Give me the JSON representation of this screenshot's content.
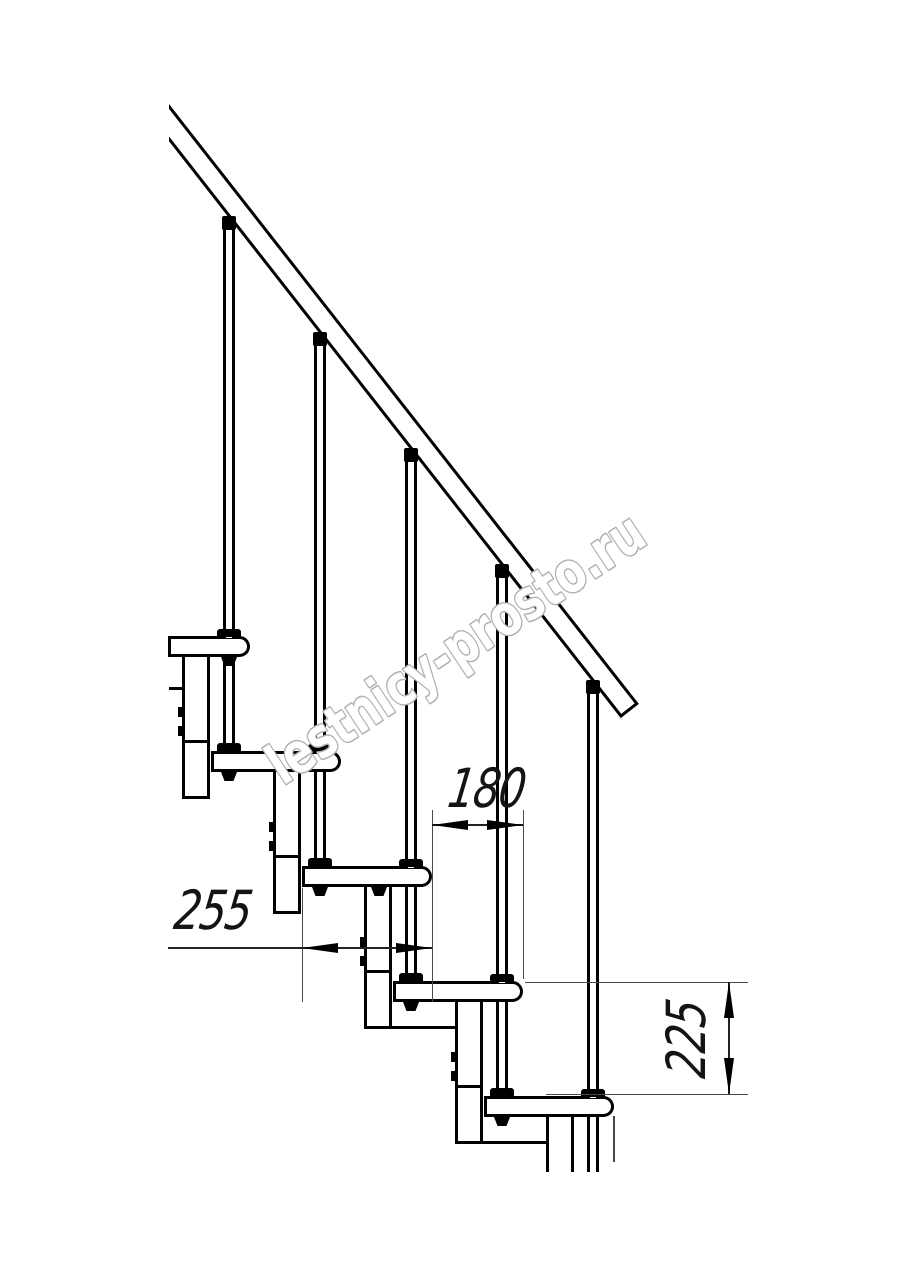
{
  "page": {
    "background": "#ffffff",
    "width": 914,
    "height": 1280
  },
  "watermark": {
    "text": "lestnicy-prosto.ru",
    "stroke_color": "#b0b0b0",
    "fill_color": "#ffffff",
    "angle_deg": -33.6,
    "x": 283,
    "y": 786,
    "font_size": 56,
    "text_length": 440
  },
  "drawing": {
    "stroke_color": "#000000",
    "thin_color": "#4a4a4a",
    "handrail": {
      "clip": {
        "left": 169,
        "top": 88,
        "width": 545,
        "height": 680
      },
      "offset_y": 16,
      "length": 762,
      "thickness": 23,
      "angle_deg": 51.93,
      "stroke": 3.5
    },
    "geometry": {
      "tread_h": 21,
      "tread_radius": 12,
      "stroke": 3,
      "module_w": 28,
      "module_depth": 163,
      "notch_dy": 104,
      "module_bolt_dy1": 71,
      "module_bolt_dy2": 90,
      "rod_w": 12,
      "foot_w": 24,
      "foot_h": 8,
      "conn_w": 14,
      "conn_h": 14,
      "nut_w": 16,
      "nut_h": 9,
      "riser": 115,
      "run": 91,
      "rod_cut_y": 1172,
      "module_cut_y": 1172
    },
    "steps": [
      {
        "nose": 250,
        "top": 636,
        "left": 168,
        "baluster_x": 229,
        "connector_top": 216,
        "nut_x": 229,
        "module_left": 182,
        "module": "full"
      },
      {
        "nose": 341,
        "top": 751,
        "left": 211,
        "baluster_x": 320,
        "connector_top": 332,
        "nut_x": 229,
        "module_left": 273,
        "module": "full"
      },
      {
        "nose": 432,
        "top": 866,
        "left": 302,
        "baluster_x": 411,
        "connector_top": 448,
        "nut_x": 320,
        "extra_nut_x": 379,
        "module_left": 364,
        "module": "full",
        "module_bottom_ext": true
      },
      {
        "nose": 523,
        "top": 981,
        "left": 393,
        "baluster_x": 502,
        "connector_top": 564,
        "nut_x": 411,
        "module_left": 455,
        "module": "full",
        "module_bottom_ext": true
      },
      {
        "nose": 614,
        "top": 1096,
        "left": 484,
        "baluster_x": 593,
        "connector_top": 680,
        "nut_x": 502,
        "module_left": 546,
        "module": "cut"
      }
    ],
    "extras": {
      "left_tick": {
        "x": 169,
        "y": 687,
        "w": 13,
        "h": 3
      },
      "thin_drop_line": {
        "x": 613,
        "y": 1116,
        "w": 2,
        "h": 46
      }
    }
  },
  "dimensions": {
    "d255": {
      "label": "255",
      "orientation": "horizontal",
      "line": {
        "x1": 168,
        "x2": 432,
        "y": 948
      },
      "arrows": [
        {
          "x": 302,
          "y": 948,
          "dir": "left"
        },
        {
          "x": 432,
          "y": 948,
          "dir": "right"
        }
      ],
      "ext": [
        {
          "x": 302,
          "y1": 888,
          "y2": 1002
        },
        {
          "x": 432,
          "y1": 810,
          "y2": 1002
        }
      ],
      "label_box": {
        "left": 172,
        "top": 884,
        "width": 90,
        "height": 48
      }
    },
    "d180": {
      "label": "180",
      "orientation": "horizontal",
      "line": {
        "x1": 432,
        "x2": 523,
        "y": 825
      },
      "arrows": [
        {
          "x": 432,
          "y": 825,
          "dir": "left"
        },
        {
          "x": 523,
          "y": 825,
          "dir": "right"
        }
      ],
      "ext": [
        {
          "x": 523,
          "y1": 810,
          "y2": 979
        }
      ],
      "label_box": {
        "left": 446,
        "top": 762,
        "width": 82,
        "height": 46
      }
    },
    "d225": {
      "label": "225",
      "orientation": "vertical",
      "line": {
        "x": 729,
        "y1": 982,
        "y2": 1094
      },
      "arrows": [
        {
          "x": 729,
          "y": 982,
          "dir": "up"
        },
        {
          "x": 729,
          "y": 1094,
          "dir": "down"
        }
      ],
      "ext": [
        {
          "y": 982,
          "x1": 525,
          "x2": 748
        },
        {
          "y": 1094,
          "x1": 546,
          "x2": 748
        }
      ],
      "label_box": {
        "left": 637,
        "top": 1012,
        "width": 100,
        "height": 54
      }
    }
  }
}
